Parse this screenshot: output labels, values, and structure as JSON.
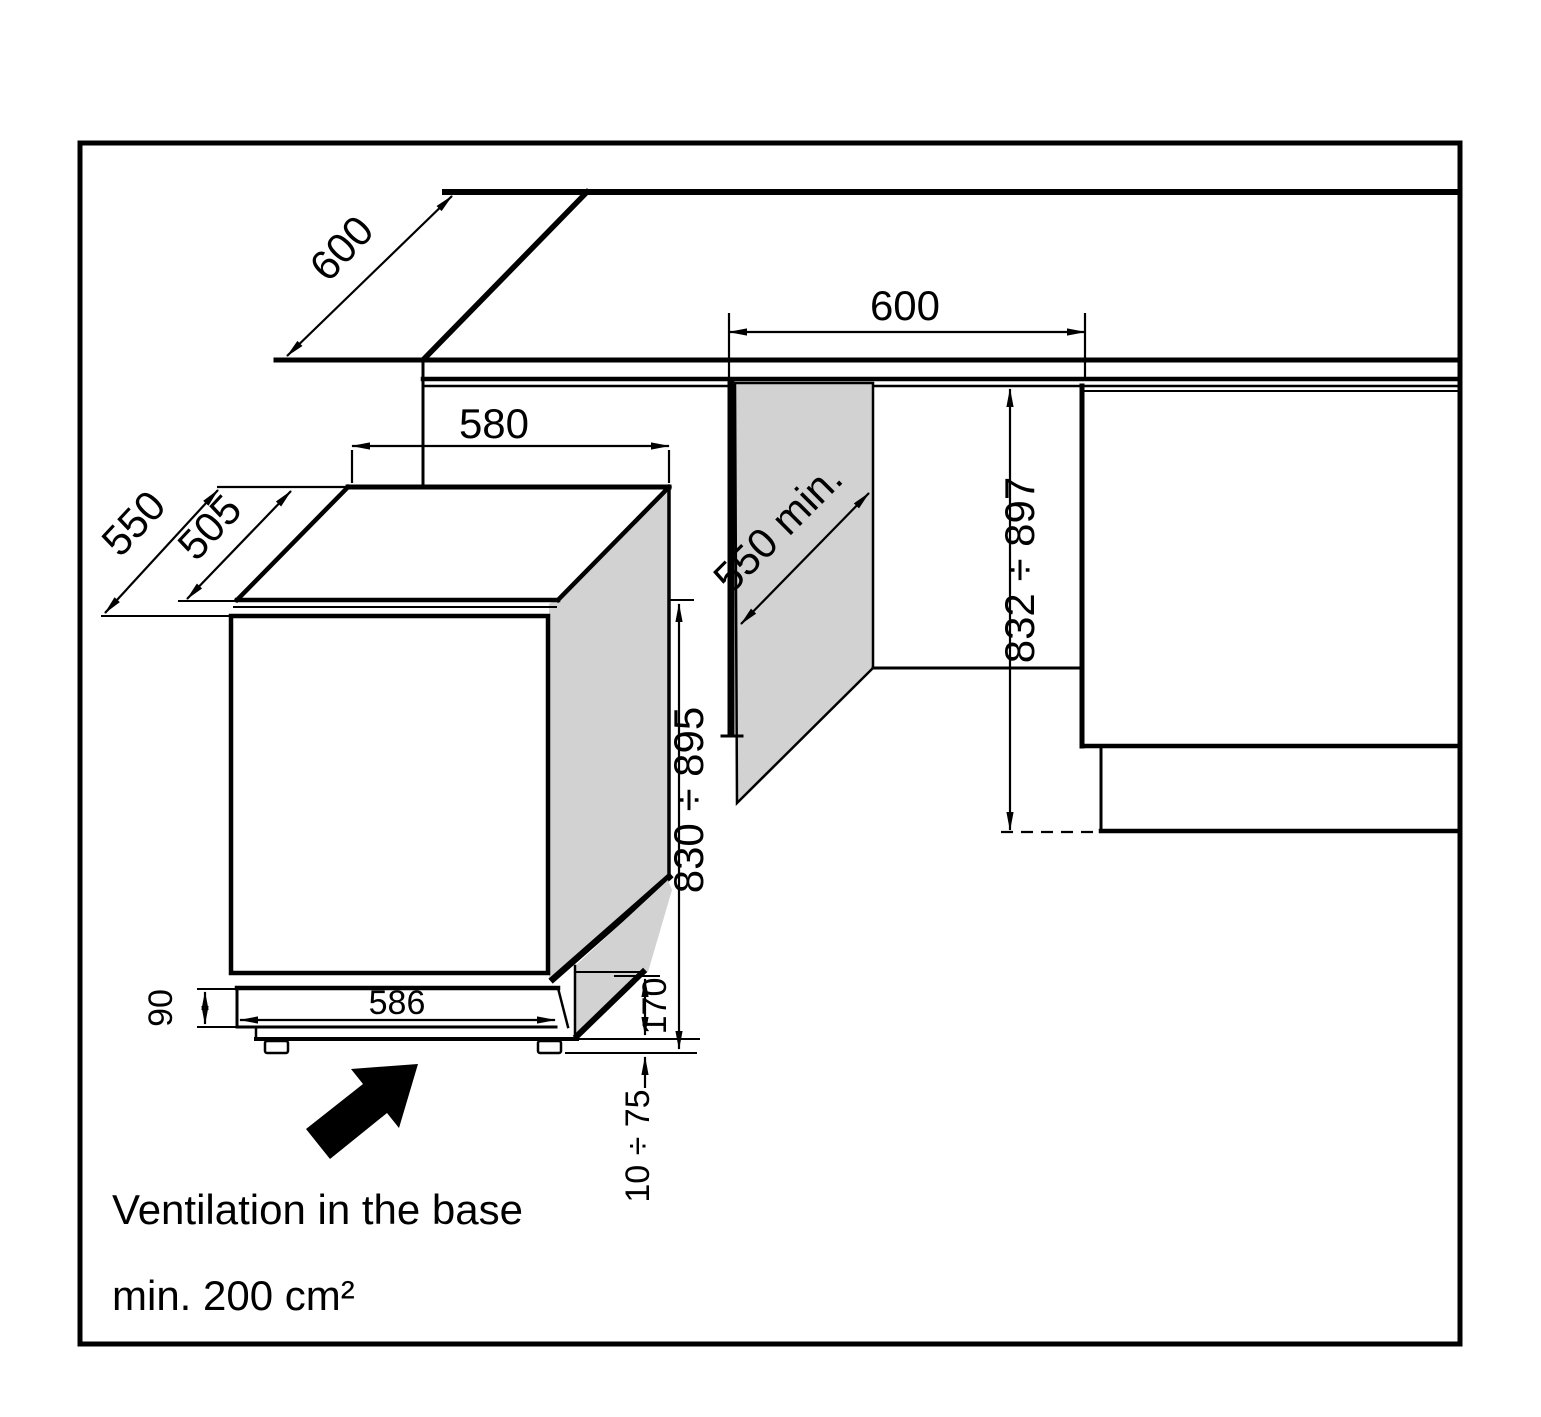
{
  "palette": {
    "line": "#000000",
    "panel": "#d2d2d2",
    "bg": "#ffffff"
  },
  "diagram": {
    "kind": "built-under appliance installation drawing",
    "dims": {
      "counter_depth": "600",
      "niche_width": "600",
      "top_width": "580",
      "depth_with_door": "550",
      "top_depth": "505",
      "niche_depth_min": "550 min.",
      "niche_height": "832 ÷ 897",
      "appliance_height": "830 ÷ 895",
      "plinth_front_height": "90",
      "base_width": "586",
      "base_recess_height": "170",
      "feet_adjust_range": "10 ÷ 75"
    },
    "notes": {
      "ventilation": "Ventilation in the base",
      "area": "min. 200 cm²"
    }
  }
}
